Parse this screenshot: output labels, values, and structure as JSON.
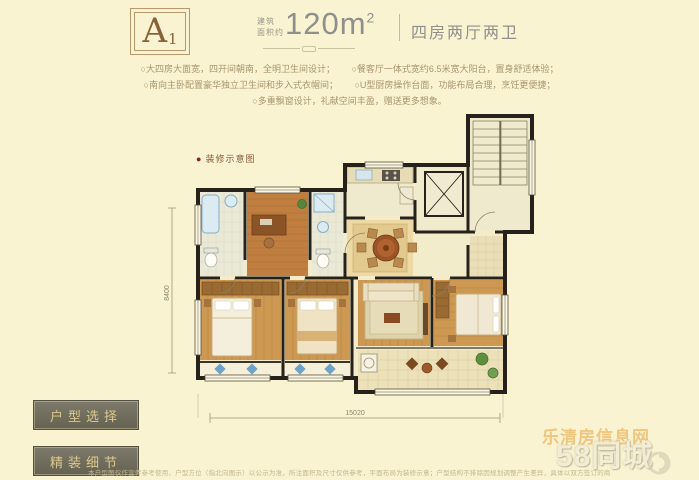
{
  "header": {
    "unit": "A",
    "unit_sub": "1",
    "area_label_top": "建筑",
    "area_label_bottom": "面积约",
    "area_value": "120m",
    "area_exp": "2",
    "layout": "四房两厅两卫"
  },
  "features": {
    "l1a": "○大四房大面宽，四开间朝南，全明卫生间设计；",
    "l1b": "○餐客厅一体式宽约6.5米宽大阳台，置身舒适体验；",
    "l2a": "○南向主卧配置豪华独立卫生间和步入式衣帽间；",
    "l2b": "○U型厨房操作台面，功能布局合理，烹饪更便捷；",
    "l3": "○多重飘窗设计，礼献空间丰盈，赠送更多想象。"
  },
  "plan": {
    "caption_bullet": "●",
    "caption": "装修示意图",
    "dims": {
      "width": "15020",
      "height": "8400"
    }
  },
  "buttons": [
    {
      "label": "户型选择"
    },
    {
      "label": "精装细节"
    }
  ],
  "watermark": {
    "site": "乐清房信息网",
    "brand": "58同城"
  },
  "disclaimer": "本户型图仅作宣传参考使用，户型方位（指北向图示）以公示为准，所注面积及尺寸仅供参考，平面布局为装修示意；户型结构不排除因规划调整产生差异，具体以双方签订的商品房买卖合同及政府最终批准文件为准。",
  "colors": {
    "background": "#f9f3d1",
    "accent_brown": "#8a6238",
    "header_gray": "#8f8f8c",
    "feature_text": "#a8956d",
    "button_bg": "#6e6a59",
    "button_text": "#dcc88e",
    "watermark_orange": "#e9a13b",
    "wall": "#26211a",
    "wood": "#c07f41"
  }
}
